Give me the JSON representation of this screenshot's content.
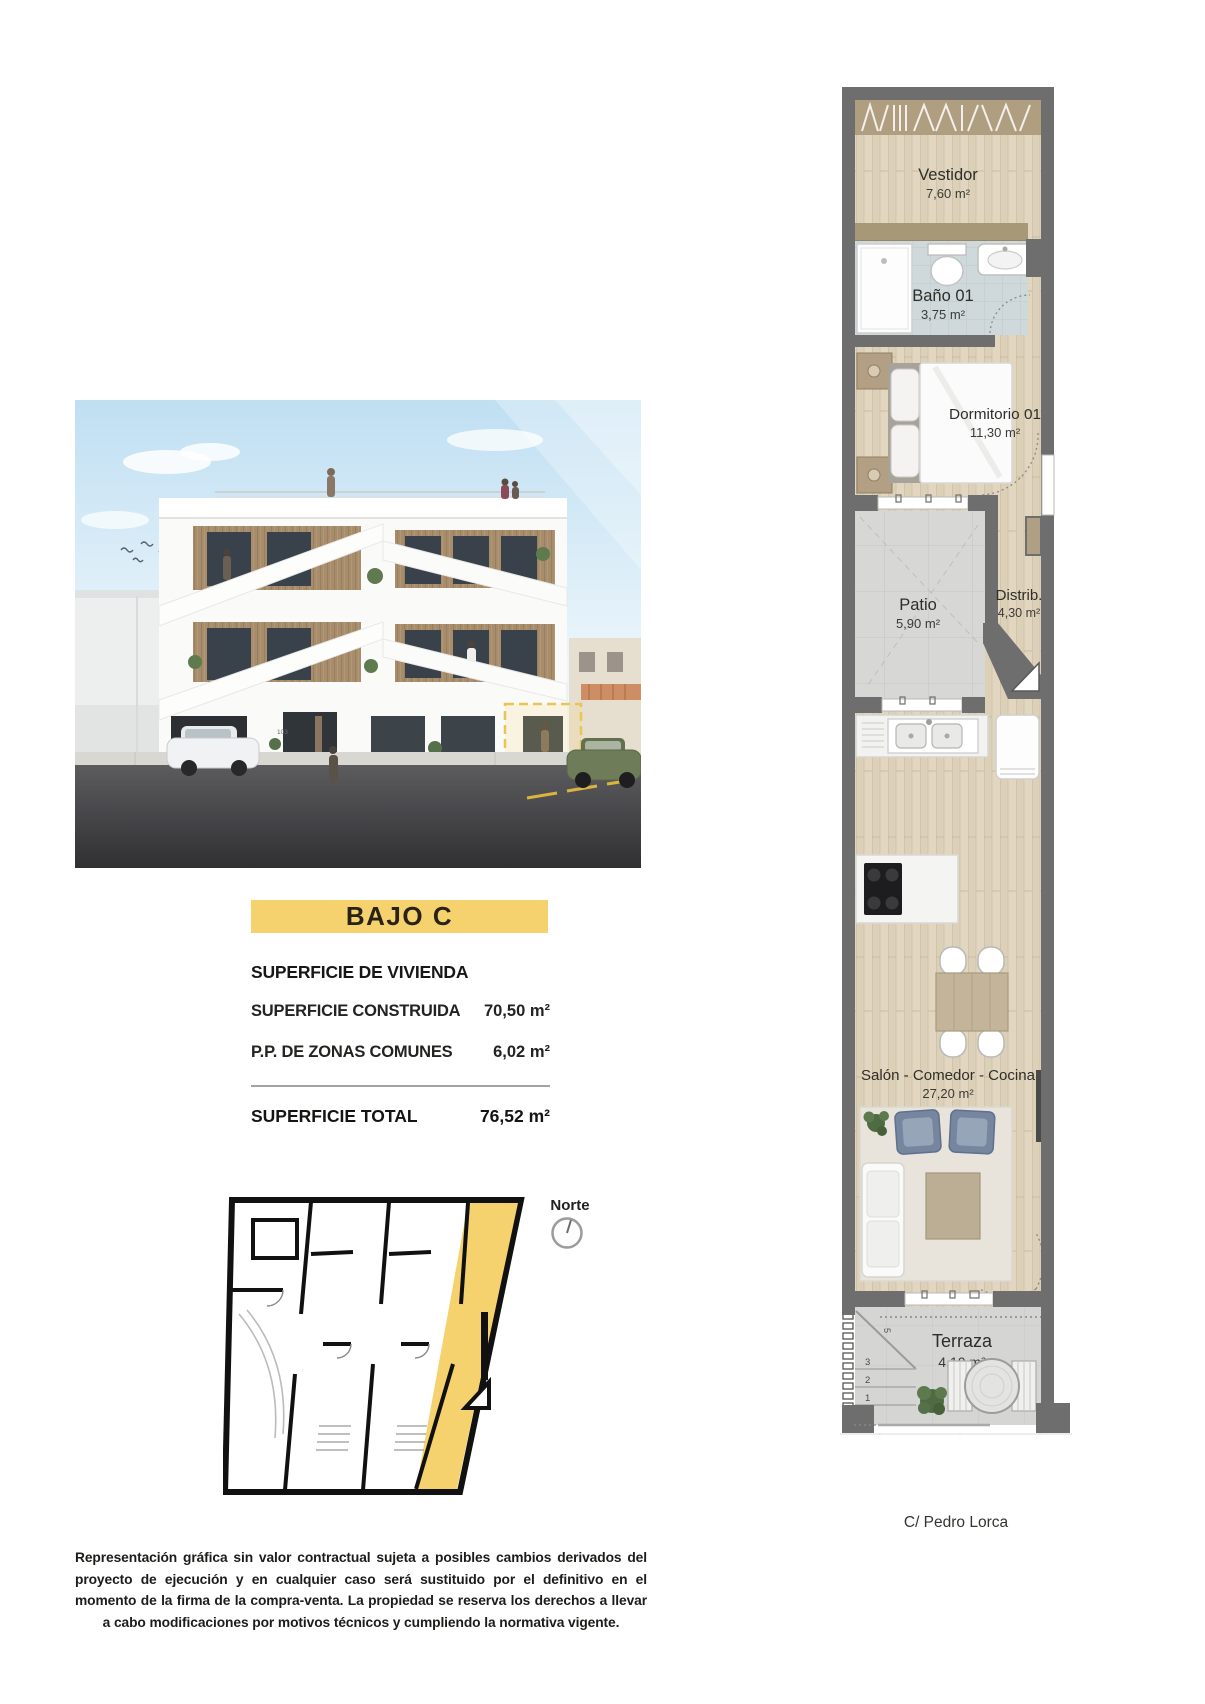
{
  "unit_banner": {
    "label": "BAJO C",
    "background": "#f5d26e"
  },
  "area_table": {
    "section_title": "SUPERFICIE DE VIVIENDA",
    "rows": [
      {
        "label": "SUPERFICIE CONSTRUIDA",
        "value": "70,50 m²"
      },
      {
        "label": "P.P. DE ZONAS COMUNES",
        "value": "6,02 m²"
      }
    ],
    "total_row": {
      "label": "SUPERFICIE TOTAL",
      "value": "76,52 m²"
    }
  },
  "floor_plan": {
    "rooms": [
      {
        "name": "Vestidor",
        "area": "7,60 m²"
      },
      {
        "name": "Baño 01",
        "area": "3,75 m²"
      },
      {
        "name": "Dormitorio 01",
        "area": "11,30 m²"
      },
      {
        "name": "Patio",
        "area": "5,90 m²"
      },
      {
        "name": "Distrib.",
        "area": "4,30 m²"
      },
      {
        "name": "Salón - Comedor - Cocina",
        "area": "27,20 m²"
      },
      {
        "name": "Terraza",
        "area": "4,10 m²"
      }
    ],
    "stair_steps": [
      "3",
      "2",
      "1"
    ],
    "stair_mark": "5",
    "street_label": "C/ Pedro Lorca"
  },
  "site_plan": {
    "north_label": "Norte"
  },
  "building_render": {
    "entrance_number": "103"
  },
  "disclaimer": "Representación gráfica sin valor contractual sujeta a posibles cambios derivados del proyecto de ejecución y en cualquier caso será sustituido por el definitivo en el momento de la firma de la compra-venta. La propiedad se reserva los derechos a llevar a cabo modificaciones por motivos técnicos y cumpliendo la normativa vigente.",
  "colors": {
    "highlight": "#f5d26e",
    "wall": "#6e6e6e",
    "wood": "#dcd0b8",
    "closet": "#ab9b7d",
    "bath_tile": "#cfd8da",
    "patio_tile": "#d7d7d5",
    "terrace_pave": "#d5d5d3",
    "rug": "#e8e4db",
    "armchair": "#76869e"
  }
}
